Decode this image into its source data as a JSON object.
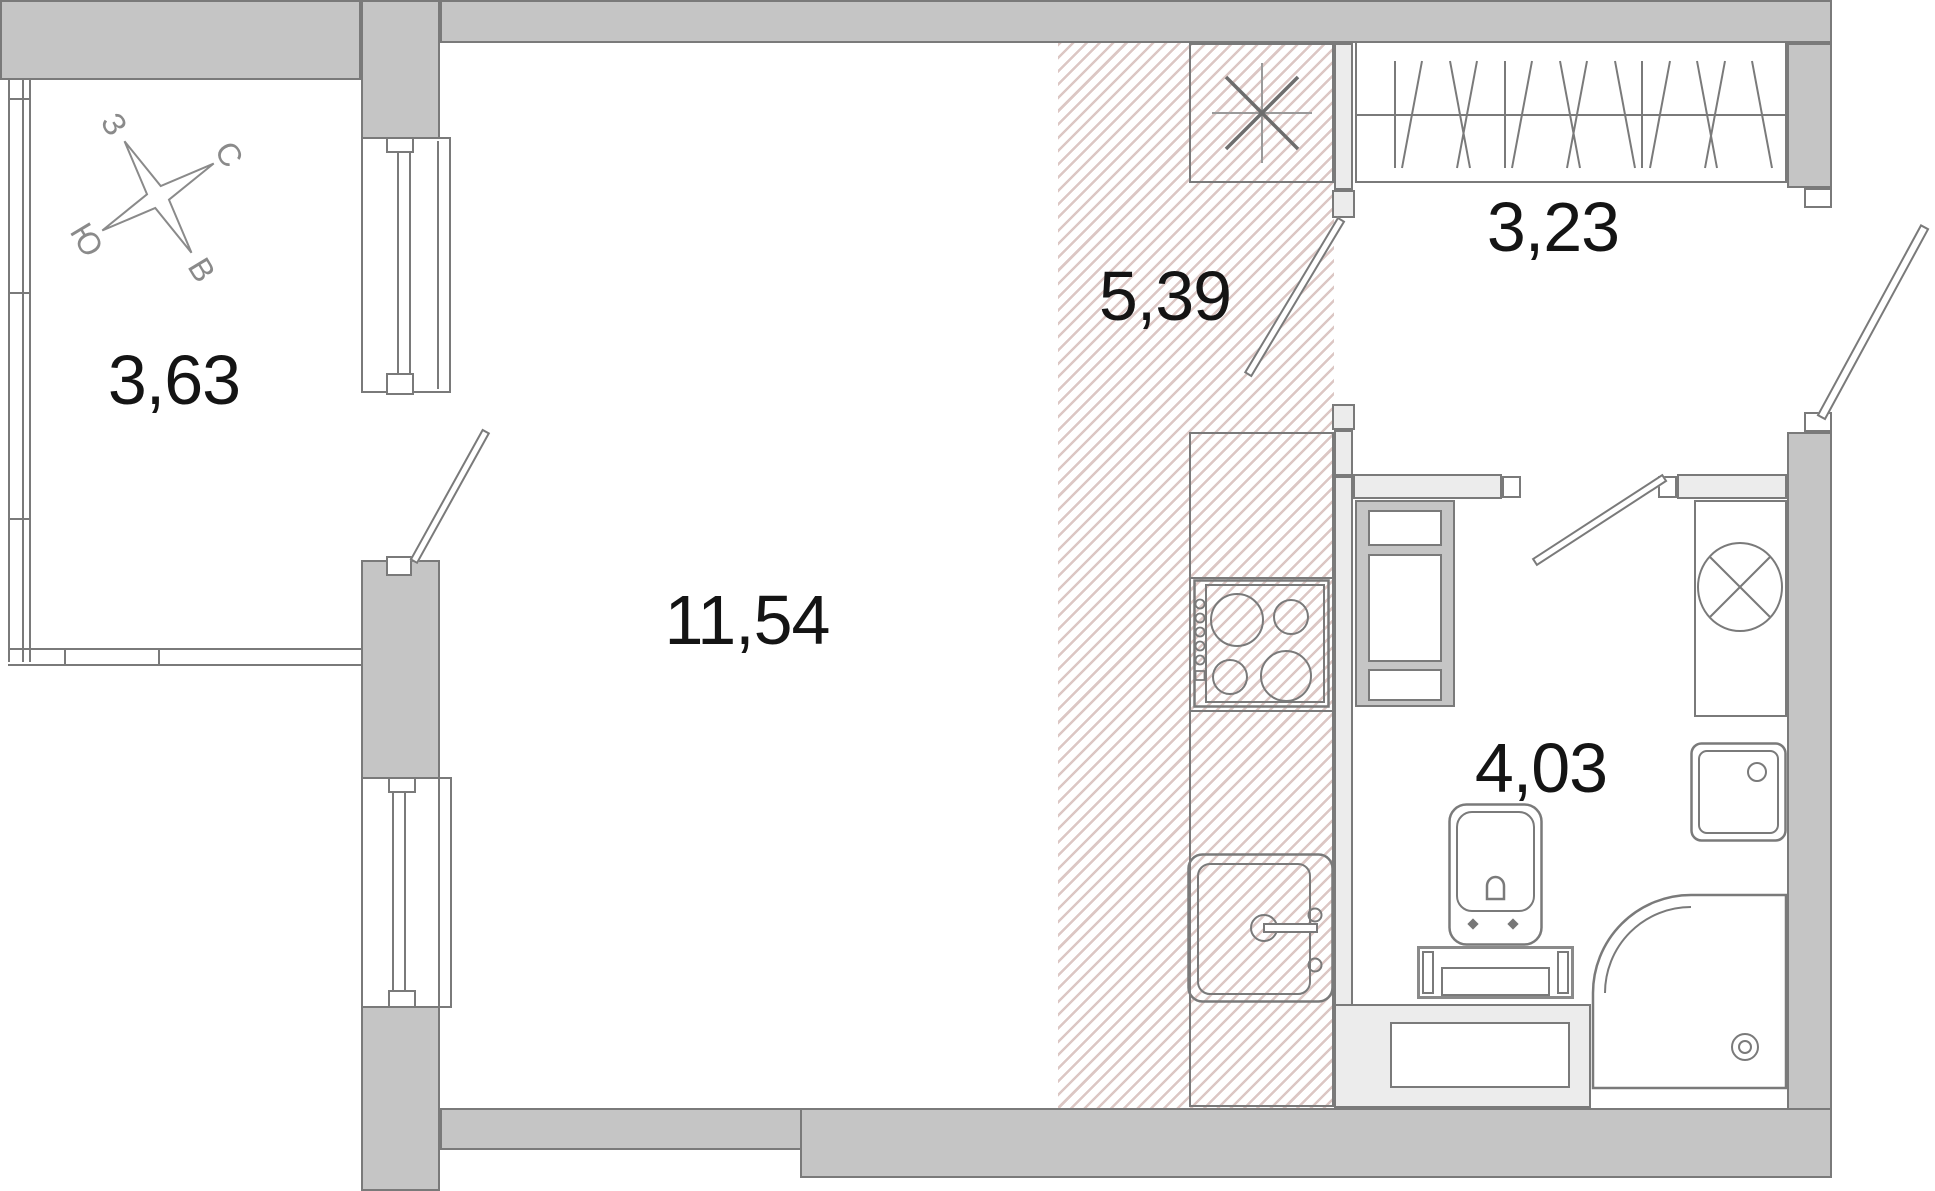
{
  "plan": {
    "title": "Studio apartment floor plan",
    "compass": {
      "north": "С",
      "east": "В",
      "south": "Ю",
      "west": "З"
    },
    "rooms": [
      {
        "id": "balcony",
        "label": "3,63"
      },
      {
        "id": "living-room",
        "label": "11,54"
      },
      {
        "id": "kitchen",
        "label": "5,39"
      },
      {
        "id": "hallway",
        "label": "3,23"
      },
      {
        "id": "bathroom",
        "label": "4,03"
      }
    ],
    "colors": {
      "wall": "#c5c5c5",
      "partition": "#ececec",
      "line": "#7a7a7a",
      "hatch": "#dcc7c4",
      "text": "#141414"
    }
  }
}
